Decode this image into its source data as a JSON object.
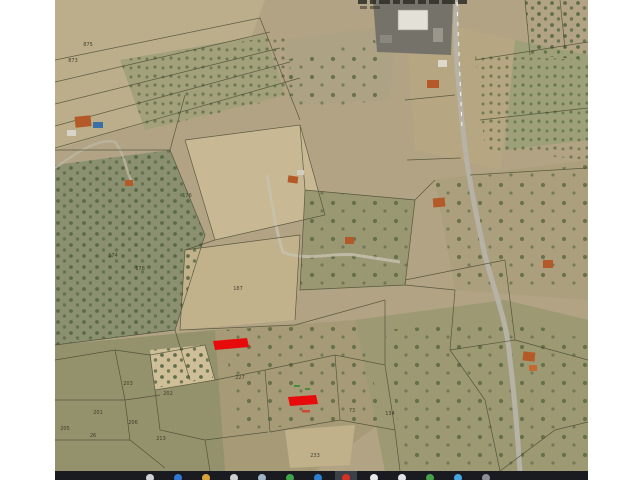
{
  "map": {
    "description_label": "aerial-cadastral-map",
    "annotation_color": "#e80b0b",
    "parcels": [
      {
        "label": "875"
      },
      {
        "label": "873"
      },
      {
        "label": "176"
      },
      {
        "label": "174"
      },
      {
        "label": "178"
      },
      {
        "label": "187"
      },
      {
        "label": "227"
      },
      {
        "label": "203"
      },
      {
        "label": "202"
      },
      {
        "label": "201"
      },
      {
        "label": "206"
      },
      {
        "label": "205"
      },
      {
        "label": "26"
      },
      {
        "label": "213"
      },
      {
        "label": "73"
      },
      {
        "label": "134"
      },
      {
        "label": "233"
      }
    ],
    "red_marks_count": "2"
  },
  "taskbar": {
    "background": "#191b20",
    "icons": [
      {
        "name": "taskbar-icon-search",
        "color": "#cfd2d6",
        "highlight": false
      },
      {
        "name": "taskbar-icon-blue-app",
        "color": "#3178d4",
        "highlight": false
      },
      {
        "name": "taskbar-icon-folder",
        "color": "#d9a43a",
        "highlight": false
      },
      {
        "name": "taskbar-icon-contact",
        "color": "#cfcfcf",
        "highlight": false
      },
      {
        "name": "taskbar-icon-gray-app",
        "color": "#9fb4c4",
        "highlight": false
      },
      {
        "name": "taskbar-icon-green-app",
        "color": "#3fa34a",
        "highlight": false
      },
      {
        "name": "taskbar-icon-blue-app-2",
        "color": "#2f7fd0",
        "highlight": false
      },
      {
        "name": "taskbar-icon-red-app-active",
        "color": "#d93025",
        "highlight": true
      },
      {
        "name": "taskbar-icon-dark-app",
        "color": "#e8e8e8",
        "highlight": false
      },
      {
        "name": "taskbar-icon-w-app",
        "color": "#dfe3e8",
        "highlight": false
      },
      {
        "name": "taskbar-icon-green-app-2",
        "color": "#46a049",
        "highlight": false
      },
      {
        "name": "taskbar-icon-blue-app-3",
        "color": "#45a6e0",
        "highlight": false
      },
      {
        "name": "taskbar-icon-gray-app-2",
        "color": "#8a8f98",
        "highlight": false
      }
    ]
  }
}
